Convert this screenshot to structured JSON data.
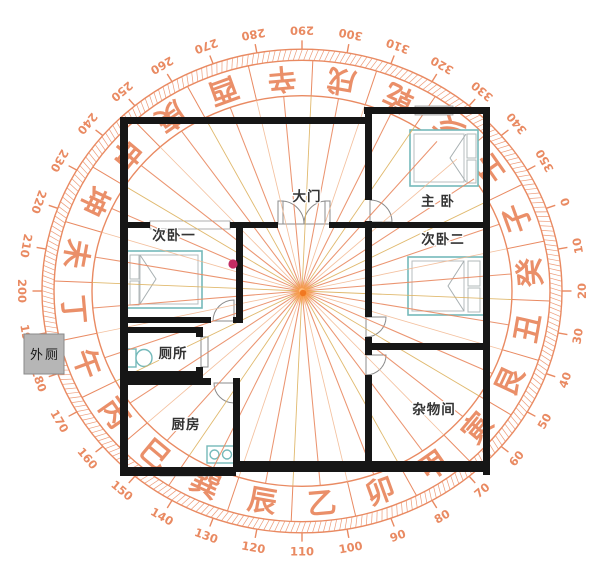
{
  "canvas": {
    "width": 611,
    "height": 568
  },
  "rooms": {
    "master": {
      "label": "主 卧"
    },
    "second1": {
      "label": "次卧一"
    },
    "second2": {
      "label": "次卧二"
    },
    "toilet": {
      "label": "厕所"
    },
    "kitchen": {
      "label": "厨房"
    },
    "storage": {
      "label": "杂物间"
    },
    "maindoor": {
      "label": "大门"
    },
    "outhouse": {
      "label": "外厕"
    }
  },
  "compass": {
    "center": {
      "x": 302,
      "y": 291
    },
    "y_scale": 0.93,
    "rotation_offset_deg": -20,
    "mountains": [
      "子",
      "癸",
      "丑",
      "艮",
      "寅",
      "甲",
      "卯",
      "乙",
      "辰",
      "巽",
      "巳",
      "丙",
      "午",
      "丁",
      "未",
      "坤",
      "申",
      "庚",
      "酉",
      "辛",
      "戌",
      "乾",
      "亥",
      "壬"
    ],
    "degree_labels": [
      0,
      10,
      20,
      30,
      40,
      50,
      60,
      70,
      80,
      90,
      100,
      110,
      120,
      130,
      140,
      150,
      160,
      170,
      180,
      190,
      200,
      210,
      220,
      230,
      240,
      250,
      260,
      270,
      280,
      290,
      300,
      310,
      320,
      330,
      340,
      350
    ],
    "radii": {
      "rays_inner": 3,
      "rays_outer": 210,
      "inner_ring": 210,
      "mountains": 229,
      "band_inner": 248,
      "band_outer": 260,
      "tick_outer": 269.5,
      "numbers": 280
    },
    "ray_count": 48,
    "fine_tick_step_deg": 1.2
  },
  "colors": {
    "compass": "#e98a62",
    "compass_light": "#f2b68e",
    "compass_gold": "#ddb25f",
    "wall": "#161616",
    "furniture": "#74b9ba",
    "label": "#333333",
    "magenta_dot": "#c32c63",
    "glow": "#ff9a3a",
    "glow_core": "#f0731c",
    "outhouse_fill": "#b6b6b6"
  }
}
